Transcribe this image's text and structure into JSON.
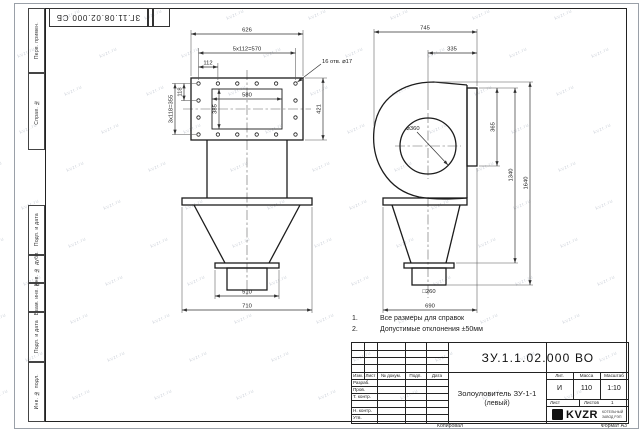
{
  "sheet": {
    "top_doc_number": "ЗГ.11.08.02.000 СБ",
    "copied_label": "Копировал",
    "format_label": "Формат A3",
    "watermark_text": "kvzr.ru"
  },
  "margin_fields": {
    "perv_primen": "Перв. примен.",
    "sprav_no": "Справ. №",
    "podp_data_1": "Подп. и дата",
    "inv_dubl": "Инв. № дубл.",
    "vzam_inv": "Взам. инв. №",
    "podp_data_2": "Подп. и дата",
    "inv_podl": "Инв. № подл."
  },
  "views": {
    "front": {
      "dim_width_outer": "626",
      "dim_bolt_span_h": "5x112=570",
      "dim_bolt_pitch": "112",
      "dim_inner_width": "580",
      "dim_inner_height": "385",
      "dim_bolt_pitch_v": "118",
      "dim_bolt_span_v": "3x118=355",
      "dim_height_outer": "421",
      "holes_callout": "16 отв. ⌀17",
      "dim_outlet_flange": "510",
      "dim_base_width": "710"
    },
    "side": {
      "dim_overall_width": "745",
      "dim_inlet_offset": "335",
      "dim_flange_height": "365",
      "dim_inlet_dia": "⌀360",
      "dim_height_flange_outlet": "1340",
      "dim_height_overall": "1640",
      "dim_outlet_square": "□260",
      "dim_base_width": "690"
    }
  },
  "notes": {
    "n1_num": "1.",
    "n1_text": "Все размеры для справок",
    "n2_num": "2.",
    "n2_text": "Допустимые отклонения ±50мм"
  },
  "title_block": {
    "doc_number": "ЗУ.1.1.02.000 ВО",
    "name_line1": "Золоуловитель ЗУ-1-1",
    "name_line2": "(левый)",
    "col_izm": "Изм.",
    "col_list": "Лист",
    "col_dokum": "№ докум.",
    "col_podp": "Подп.",
    "col_data": "Дата",
    "row_razrab": "Разраб.",
    "row_prov": "Пров.",
    "row_tkontr": "Т. контр.",
    "row_nkontr": "Н. контр.",
    "row_utv": "Утв.",
    "lit_label": "Лит.",
    "mass_label": "Масса",
    "scale_label": "Масштаб",
    "lit_value": "И",
    "mass_value": "110",
    "scale_value": "1:10",
    "list_label": "Лист",
    "listov_label": "Листов",
    "listov_value": "1",
    "logo_text": "KVZR",
    "logo_sub1": "КОТЕЛЬНЫЙ",
    "logo_sub2": "ЗАВОД РЭП"
  }
}
